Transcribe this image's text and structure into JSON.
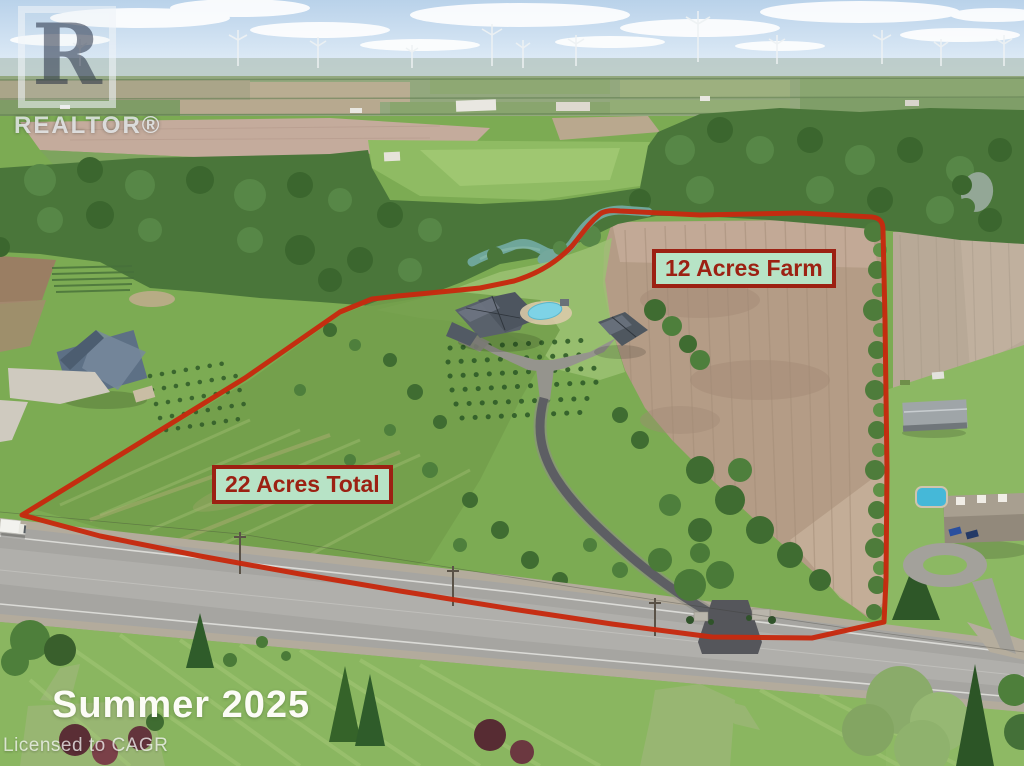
{
  "photo": {
    "description": "Aerial drone photo of rural property with red outlined lot, farm fields, houses, winding driveway and country road"
  },
  "watermark": {
    "logo_letter": "R",
    "brand": "REALTOR®",
    "license": "Licensed to CAGR"
  },
  "annotations": {
    "farm_label": "12 Acres Farm",
    "total_label": "22 Acres Total",
    "season_label": "Summer 2025"
  },
  "colors": {
    "boundary_red": "#c6290e",
    "label_background": "#b7e3c6",
    "label_border": "#9c2113",
    "label_text": "#9c2113"
  }
}
